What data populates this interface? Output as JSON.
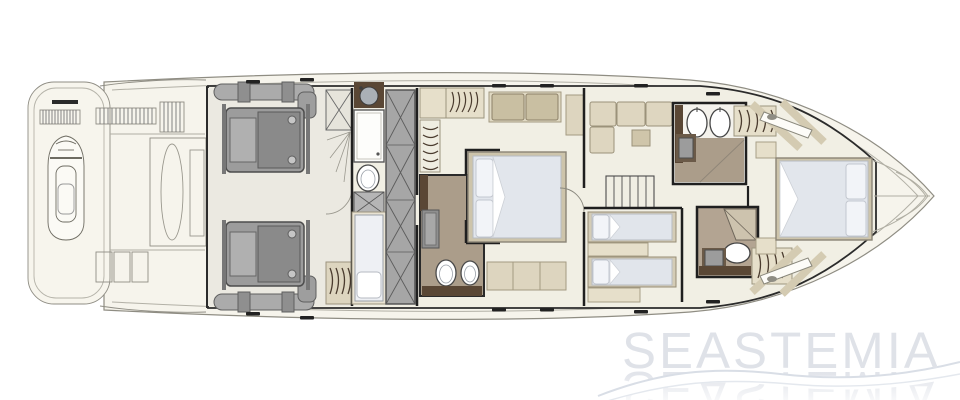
{
  "watermark": {
    "text": "SEASTEMIA"
  },
  "colors": {
    "hull_fill": "#f6f4ec",
    "floor": "#f1efe4",
    "engine_room_floor": "#ebe9e1",
    "bathroom_taupe": "#ab9d8a",
    "tan_light": "#e6dfca",
    "tan_mid": "#cfc5aa",
    "sofa_cushion": "#c9bfa2",
    "dark_brown": "#5a4735",
    "machinery_gray": "#9c9c9c",
    "wardrobe_gray": "#a6a6a6",
    "mattress": "#e2e6ec",
    "pillow": "#f2f4f8",
    "wall": "#1f1f1f",
    "watermark_text": "#dfe2e8",
    "wave": "#d9dee6"
  },
  "diagram": {
    "type": "yacht-lower-deck-plan",
    "orientation": "bow-right-stern-left",
    "zones": [
      {
        "name": "swim-platform-tender-garage",
        "features": [
          "jet-ski",
          "vent-grilles",
          "garage-hatch"
        ]
      },
      {
        "name": "engine-room",
        "features": [
          "port-engine",
          "starboard-engine",
          "exhaust-piping"
        ]
      },
      {
        "name": "crew-cabin",
        "features": [
          "berth",
          "galley-sink",
          "shower",
          "toilet",
          "x-front-wardrobe",
          "hanging-locker"
        ]
      },
      {
        "name": "master-cabin",
        "features": [
          "double-bed",
          "sofa",
          "hanging-wardrobes",
          "ensuite-bathroom",
          "shower",
          "twin-toilets",
          "vanity"
        ]
      },
      {
        "name": "companionway-lounge",
        "features": [
          "l-sofa",
          "table",
          "staircase"
        ]
      },
      {
        "name": "twin-guest-cabin",
        "features": [
          "two-single-beds",
          "nightstand"
        ]
      },
      {
        "name": "forward-day-head",
        "features": [
          "toilet",
          "bidet",
          "sink",
          "shower",
          "hanging-locker"
        ]
      },
      {
        "name": "mid-day-head",
        "features": [
          "corner-shower",
          "toilet",
          "sink",
          "vanity",
          "hanging-locker"
        ]
      },
      {
        "name": "vip-cabin",
        "features": [
          "double-bed",
          "side-windows",
          "nightstands"
        ]
      },
      {
        "name": "bow-deck"
      }
    ]
  }
}
